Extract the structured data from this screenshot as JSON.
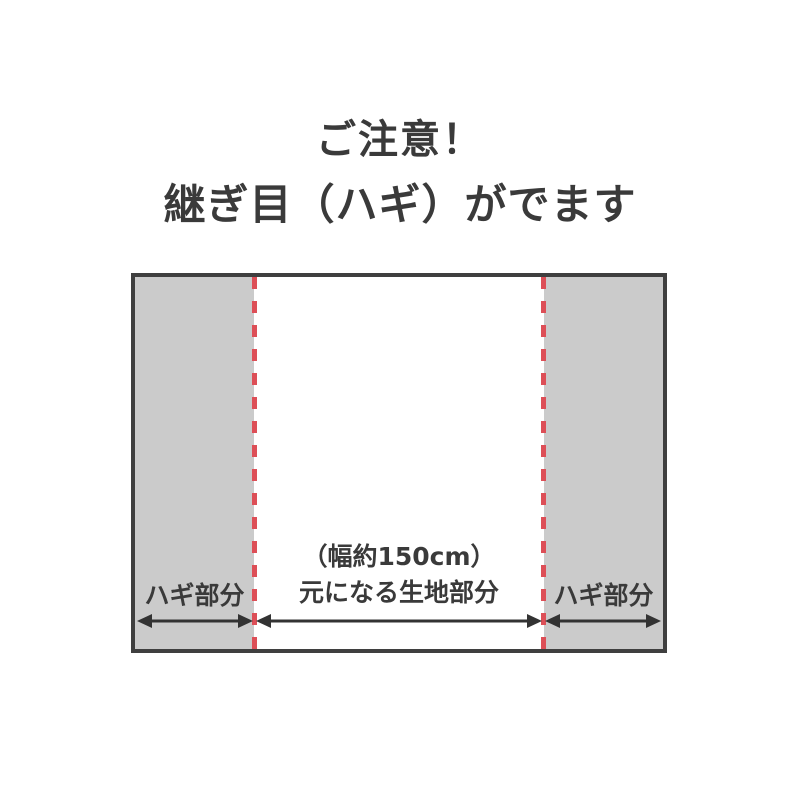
{
  "title": {
    "line1": "ご注意！",
    "line2": "継ぎ目（ハギ）がでます"
  },
  "diagram": {
    "left_section_label": "ハギ部分",
    "center_section_label_line1": "（幅約150cm）",
    "center_section_label_line2": "元になる生地部分",
    "right_section_label": "ハギ部分",
    "colors": {
      "panel_gray": "#cbcbcb",
      "border_dark": "#3f3f3f",
      "seam_red": "#dd4f57",
      "text_dark": "#3a3a3a",
      "arrow_dark": "#333333"
    }
  }
}
